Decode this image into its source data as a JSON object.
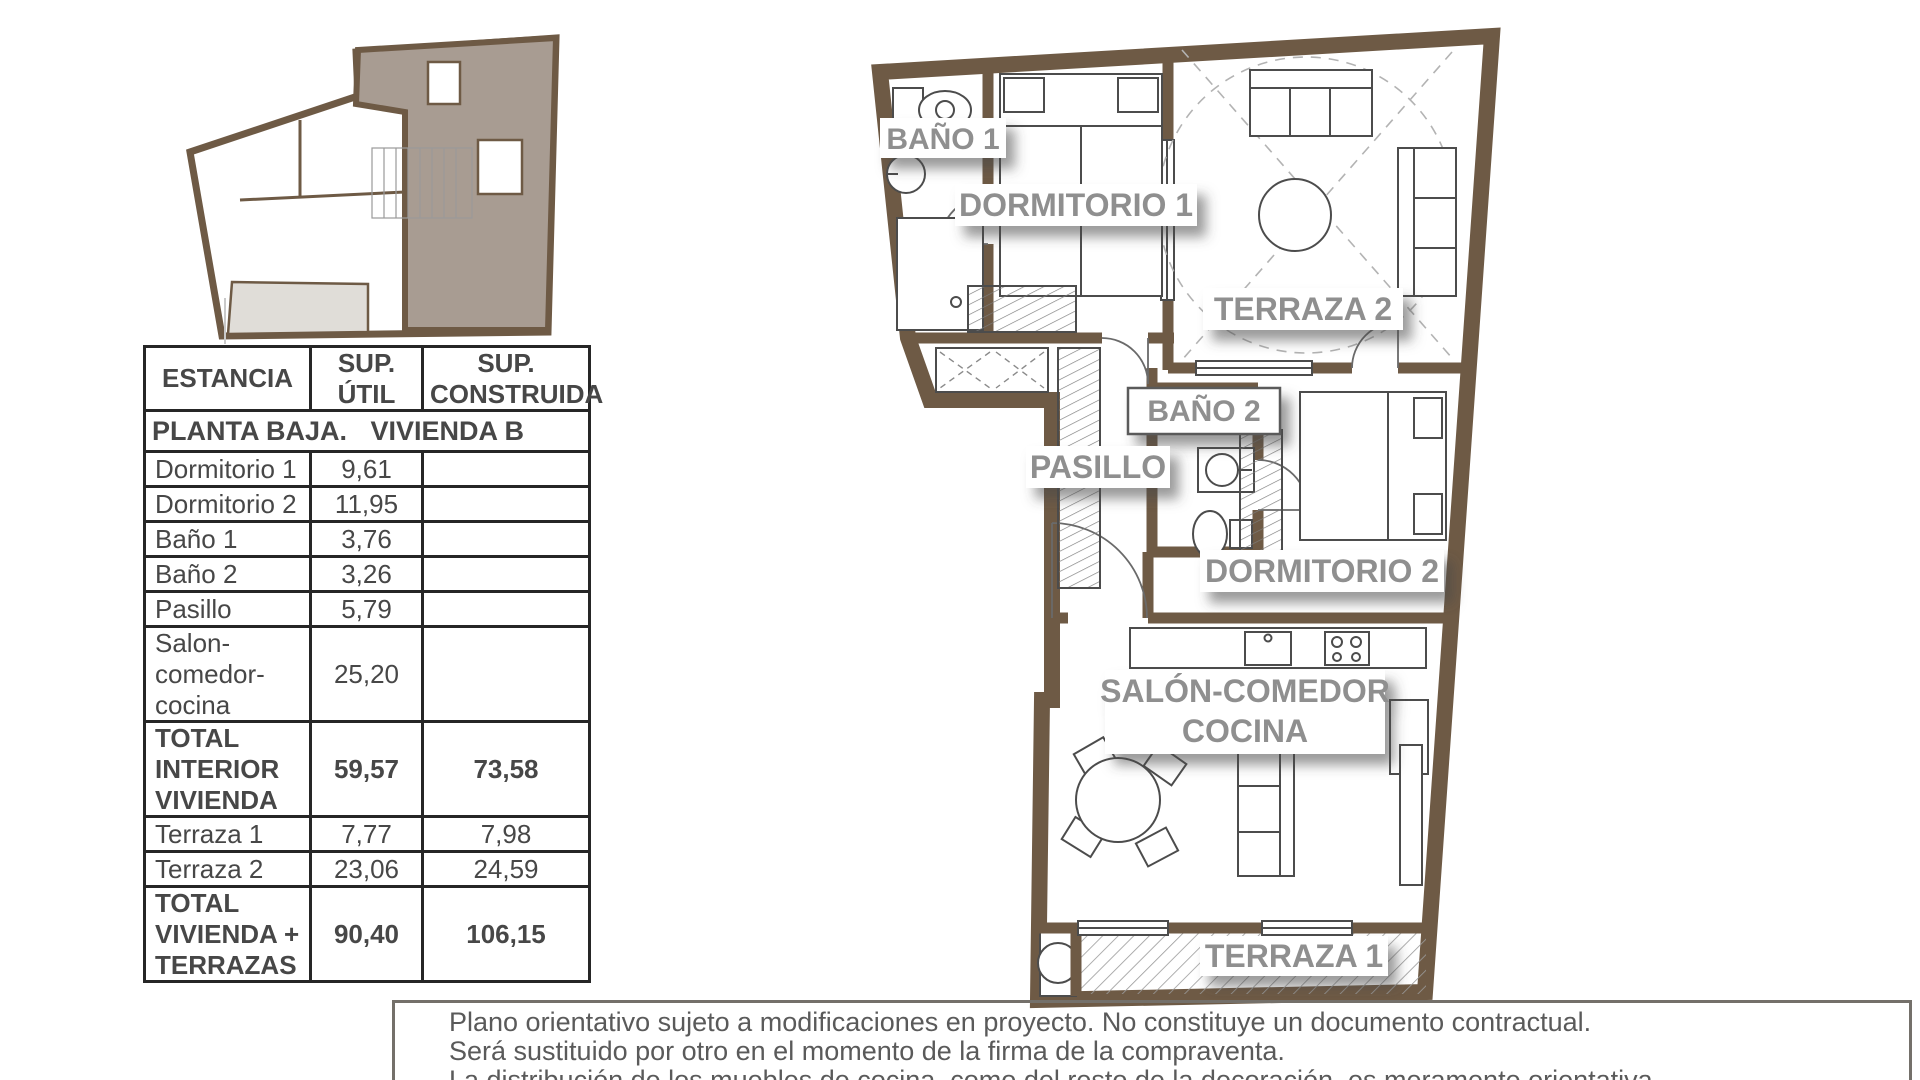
{
  "colors": {
    "wall_brown": "#6e5a45",
    "highlight_unit_fill": "#a89c92",
    "key_plan_terrace_fill": "#e0ddd8",
    "room_label_gray": "#8f8f8f",
    "table_border": "#262626",
    "disclaimer_text": "#5a5a5a"
  },
  "table": {
    "headers": [
      {
        "line1": "ESTANCIA",
        "line2": ""
      },
      {
        "line1": "SUP.",
        "line2": "ÚTIL"
      },
      {
        "line1": "SUP.",
        "line2": "CONSTRUIDA"
      }
    ],
    "section": {
      "left": "PLANTA BAJA.",
      "right": "VIVIENDA B"
    },
    "rows": [
      {
        "lines": [
          "Dormitorio 1"
        ],
        "util": "9,61",
        "cons": ""
      },
      {
        "lines": [
          "Dormitorio 2"
        ],
        "util": "11,95",
        "cons": ""
      },
      {
        "lines": [
          "Baño 1"
        ],
        "util": "3,76",
        "cons": ""
      },
      {
        "lines": [
          "Baño 2"
        ],
        "util": "3,26",
        "cons": ""
      },
      {
        "lines": [
          "Pasillo"
        ],
        "util": "5,79",
        "cons": ""
      },
      {
        "lines": [
          "Salon-",
          "comedor-",
          "cocina"
        ],
        "util": "25,20",
        "cons": ""
      },
      {
        "lines": [
          "TOTAL",
          "INTERIOR",
          "VIVIENDA"
        ],
        "util": "59,57",
        "cons": "73,58"
      },
      {
        "lines": [
          "Terraza 1"
        ],
        "util": "7,77",
        "cons": "7,98"
      },
      {
        "lines": [
          "Terraza 2"
        ],
        "util": "23,06",
        "cons": "24,59"
      },
      {
        "lines": [
          "TOTAL",
          "VIVIENDA +",
          "TERRAZAS"
        ],
        "util": "90,40",
        "cons": "106,15"
      }
    ]
  },
  "plan": {
    "labels": {
      "bano1": "BAÑO 1",
      "dormitorio1": "DORMITORIO 1",
      "terraza2": "TERRAZA 2",
      "bano2": "BAÑO 2",
      "pasillo": "PASILLO",
      "dormitorio2": "DORMITORIO 2",
      "salon_line1": "SALÓN-COMEDOR",
      "salon_line2": "COCINA",
      "terraza1": "TERRAZA 1"
    }
  },
  "disclaimer": {
    "lines": [
      "Plano orientativo sujeto a modificaciones en proyecto. No constituye un documento contractual.",
      "Será sustituido por otro en el momento de la firma de la compraventa.",
      "La distribución de los muebles de cocina, como del resto de la decoración, es meramente orientativa."
    ]
  }
}
